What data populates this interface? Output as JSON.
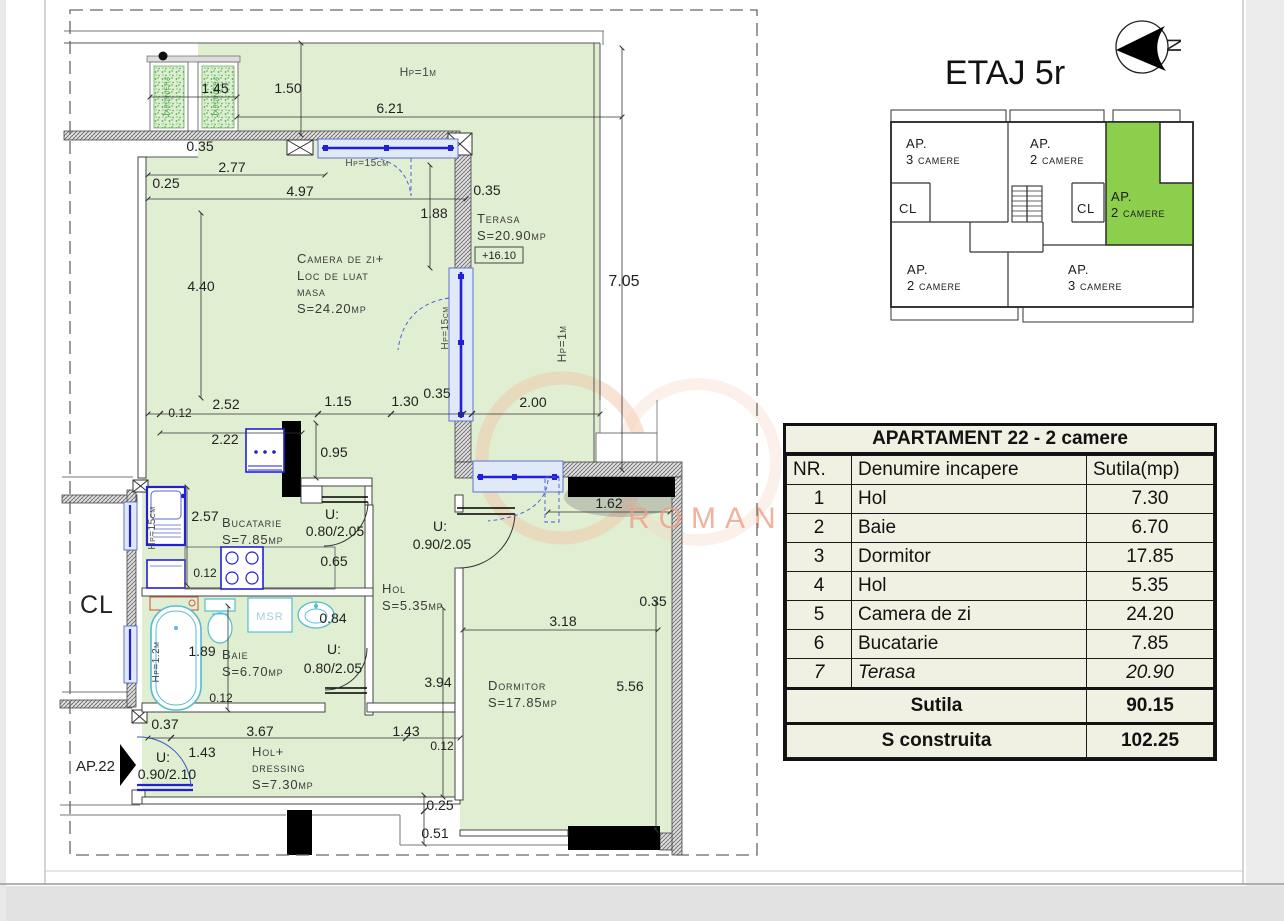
{
  "header": {
    "floor_title": "ETAJ 5r",
    "compass_letter": "N"
  },
  "colors": {
    "plan_green": "#e0eed2",
    "highlight_green": "#8ccf4d",
    "window_blue": "#2020d8",
    "fixture_cyan": "#52bdd3",
    "watermark_salmon": "#ef9f86",
    "table_bg": "#f0f0e3"
  },
  "key_plan": {
    "ap_top_left": [
      "AP.",
      "3 camere"
    ],
    "ap_top_mid": [
      "AP.",
      "2 camere"
    ],
    "cl_left": "CL",
    "cl_right": "CL",
    "ap_right": [
      "AP.",
      "2 camere"
    ],
    "ap_bottom_left": [
      "AP.",
      "2 camere"
    ],
    "ap_bottom_right": [
      "AP.",
      "3 camere"
    ]
  },
  "watermark": {
    "text": "ROMANIA"
  },
  "plan": {
    "rooms": {
      "living": [
        "Camera de zi+",
        "Loc de luat",
        "masa",
        "S=24.20mp"
      ],
      "terasa": [
        "Terasa",
        "S=20.90mp"
      ],
      "terasa_level": "+16.10",
      "bucatarie": [
        "Bucatarie",
        "S=7.85mp"
      ],
      "hol": [
        "Hol",
        "S=5.35mp"
      ],
      "baie": [
        "Baie",
        "S=6.70mp"
      ],
      "dormitor": [
        "Dormitor",
        "S=17.85mp"
      ],
      "hol_dressing": [
        "Hol+",
        "dressing",
        "S=7.30mp"
      ],
      "msr": "MSR",
      "cl": "CL",
      "ap22": "AP.22",
      "jardiniera": "Jardiniera"
    },
    "dims": [
      "1.45",
      "1.50",
      "Hp=1m",
      "6.21",
      "0.35",
      "Hp=15cm",
      "2.77",
      "0.25",
      "4.97",
      "0.35",
      "1.88",
      "7.05",
      "4.40",
      "Hp=15cm",
      "Hp=1m",
      "0.35",
      "2.52",
      "1.15",
      "1.30",
      "2.00",
      "0.12",
      "2.22",
      "0.95",
      "2.57",
      "0.12",
      "0.65",
      "0.84",
      "1.62",
      "0.35",
      "3.18",
      "1.89",
      "0.12",
      "3.94",
      "5.56",
      "0.37",
      "3.67",
      "1.43",
      "0.12",
      "1.43",
      "0.25",
      "0.51",
      "Hp=15cm",
      "Hp=1.2m"
    ],
    "door_labels": [
      "U:",
      "0.80/2.05",
      "U:",
      "0.90/2.05",
      "U:",
      "0.80/2.05",
      "U:",
      "0.90/2.10"
    ]
  },
  "table": {
    "title": "APARTAMENT 22 - 2 camere",
    "headers": [
      "NR.",
      "Denumire incapere",
      "Sutila(mp)"
    ],
    "rows": [
      {
        "nr": "1",
        "name": "Hol",
        "area": "7.30"
      },
      {
        "nr": "2",
        "name": "Baie",
        "area": "6.70"
      },
      {
        "nr": "3",
        "name": "Dormitor",
        "area": "17.85"
      },
      {
        "nr": "4",
        "name": "Hol",
        "area": "5.35"
      },
      {
        "nr": "5",
        "name": "Camera de zi",
        "area": "24.20"
      },
      {
        "nr": "6",
        "name": "Bucatarie",
        "area": "7.85"
      },
      {
        "nr": "7",
        "name": "Terasa",
        "area": "20.90"
      }
    ],
    "total_label": "Sutila",
    "total_value": "90.15",
    "built_label": "S construita",
    "built_value": "102.25"
  }
}
